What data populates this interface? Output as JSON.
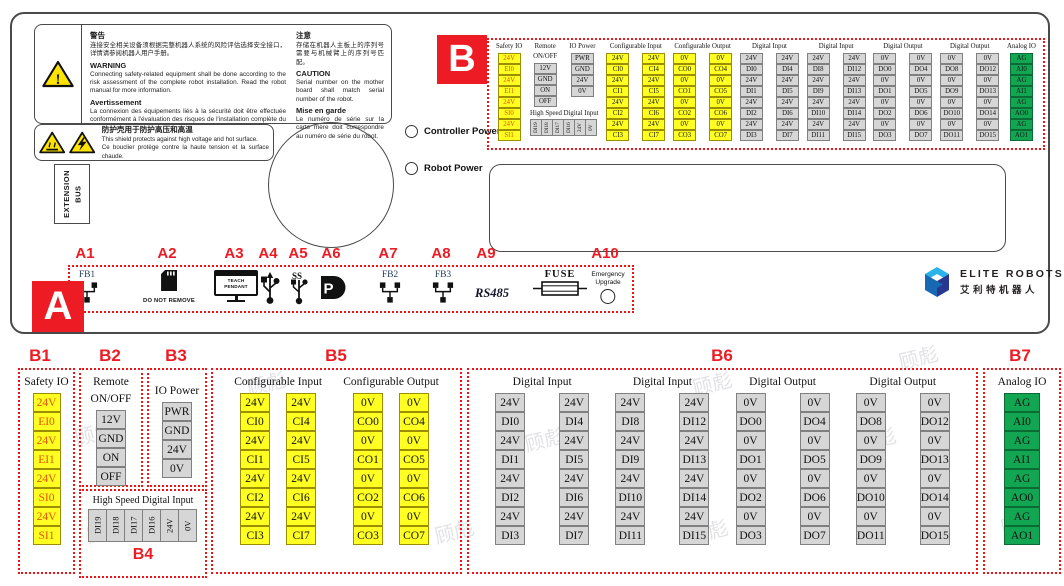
{
  "squares": {
    "a": "A",
    "b": "B"
  },
  "warning1": {
    "zh_title": "警告",
    "zh_body": "连接安全相关设备须根据完整机器人系统的风险评估选择安全接口，详情请参阅机器人用户手册。",
    "en_title": "WARNING",
    "en_body": "Connecting safety-related equipment shall be done according to the risk assessment of the complete robot installation. Read the robot manual for more information.",
    "fr_title": "Avertissement",
    "fr_body": "La connexion des équipements liés à la sécurité doit être effectuée conformément à l'évaluation des risques de l'installation complète du robot. Lisez le manuel du robot pour plus d'informations.",
    "zh2_title": "注意",
    "zh2_body": "存储在机器人主板上的序列号需要与机械臂上的序列号匹配。",
    "en2_title": "CAUTION",
    "en2_body": "Serial number on the mother board shall match serial number of the robot.",
    "fr2_title": "Mise en garde",
    "fr2_body": "Le numéro de série sur la carte mère doit correspondre au numéro de série du robot."
  },
  "warning2": {
    "zh": "防护壳用于防护高压和高温",
    "en": "This shield protects against high voltage and hot surface.",
    "fr": "Ce bouclier protège contre la haute tension et la surface chaude."
  },
  "extension_bus": {
    "line1": "EXTENSION",
    "line2": "BUS"
  },
  "leds": {
    "controller": "Controller Power",
    "robot": "Robot Power"
  },
  "logo": {
    "en": "ELITE ROBOTS",
    "zh": "艾利特机器人"
  },
  "a_section": {
    "labels": [
      "A1",
      "A2",
      "A3",
      "A4",
      "A5",
      "A6",
      "A7",
      "A8",
      "A9",
      "A10"
    ],
    "fb1": "FB1",
    "fb2": "FB2",
    "fb3": "FB3",
    "sd_note": "DO NOT REMOVE",
    "teach_line1": "TEACH",
    "teach_line2": "PENDANT",
    "rs485": "RS485",
    "fuse": "FUSE",
    "emergency_line1": "Emergency",
    "emergency_line2": "Upgrade"
  },
  "b_section": {
    "sub_labels": [
      "B1",
      "B2",
      "B3",
      "B4",
      "B5",
      "B6",
      "B7"
    ]
  },
  "io": {
    "safety": {
      "title": "Safety IO",
      "cells": [
        "24V",
        "EI0",
        "24V",
        "EI1",
        "24V",
        "SI0",
        "24V",
        "SI1"
      ]
    },
    "remote": {
      "title_l1": "Remote",
      "title_l2": "ON/OFF",
      "cells": [
        "12V",
        "GND",
        "ON",
        "OFF"
      ]
    },
    "io_power": {
      "title": "IO Power",
      "cells": [
        "PWR",
        "GND",
        "24V",
        "0V"
      ]
    },
    "hsdi": {
      "title": "High Speed Digital Input",
      "cells": [
        "DI19",
        "DI18",
        "DI17",
        "DI16",
        "24V",
        "0V"
      ]
    },
    "config_input": {
      "title": "Configurable Input",
      "cols": [
        [
          "24V",
          "CI0",
          "24V",
          "CI1",
          "24V",
          "CI2",
          "24V",
          "CI3"
        ],
        [
          "24V",
          "CI4",
          "24V",
          "CI5",
          "24V",
          "CI6",
          "24V",
          "CI7"
        ]
      ]
    },
    "config_output": {
      "title": "Configurable Output",
      "cols": [
        [
          "0V",
          "CO0",
          "0V",
          "CO1",
          "0V",
          "CO2",
          "0V",
          "CO3"
        ],
        [
          "0V",
          "CO4",
          "0V",
          "CO5",
          "0V",
          "CO6",
          "0V",
          "CO7"
        ]
      ]
    },
    "digital_input_a": {
      "title": "Digital Input",
      "cols": [
        [
          "24V",
          "DI0",
          "24V",
          "DI1",
          "24V",
          "DI2",
          "24V",
          "DI3"
        ],
        [
          "24V",
          "DI4",
          "24V",
          "DI5",
          "24V",
          "DI6",
          "24V",
          "DI7"
        ]
      ]
    },
    "digital_input_b": {
      "title": "Digital Input",
      "cols": [
        [
          "24V",
          "DI8",
          "24V",
          "DI9",
          "24V",
          "DI10",
          "24V",
          "DI11"
        ],
        [
          "24V",
          "DI12",
          "24V",
          "DI13",
          "24V",
          "DI14",
          "24V",
          "DI15"
        ]
      ]
    },
    "digital_output_a": {
      "title": "Digital Output",
      "cols": [
        [
          "0V",
          "DO0",
          "0V",
          "DO1",
          "0V",
          "DO2",
          "0V",
          "DO3"
        ],
        [
          "0V",
          "DO4",
          "0V",
          "DO5",
          "0V",
          "DO6",
          "0V",
          "DO7"
        ]
      ]
    },
    "digital_output_b": {
      "title": "Digital Output",
      "cols": [
        [
          "0V",
          "DO8",
          "0V",
          "DO9",
          "0V",
          "DO10",
          "0V",
          "DO11"
        ],
        [
          "0V",
          "DO12",
          "0V",
          "DO13",
          "0V",
          "DO14",
          "0V",
          "DO15"
        ]
      ]
    },
    "analog": {
      "title": "Analog IO",
      "cells": [
        "AG",
        "AI0",
        "AG",
        "AI1",
        "AG",
        "AO0",
        "AG",
        "AO1"
      ]
    }
  },
  "colors": {
    "cell_yellow": "#ffff21",
    "cell_gray": "#d6d6d6",
    "cell_green": "#12a653",
    "accent_red": "#ed1c24",
    "safety_text": "#e25408"
  },
  "watermark": "顾彪"
}
